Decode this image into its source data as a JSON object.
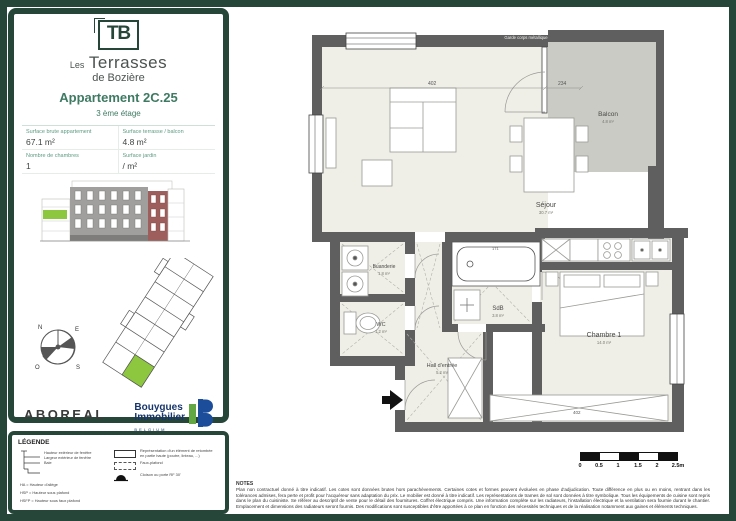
{
  "panel": {
    "logo_monogram": "TB",
    "brand_small": "Les",
    "brand_large": "Terrasses",
    "brand_sub": "de Bozière",
    "apartment_title": "Appartement 2C.25",
    "floor": "3 ème étage",
    "fields": [
      {
        "label": "Surface brute appartement",
        "value": "67.1 m²"
      },
      {
        "label": "Surface terrasse / balcon",
        "value": "4.8 m²"
      },
      {
        "label": "Nombre de chambres",
        "value": "1"
      },
      {
        "label": "Surface jardin",
        "value": "/ m²"
      }
    ],
    "logos": {
      "aboreal": "ABOREAL",
      "bouygues_line1": "Bouygues",
      "bouygues_line2": "Immobilier",
      "bouygues_sub": "BELGIUM"
    }
  },
  "compass": {
    "north": "N",
    "east": "E",
    "south": "S",
    "west": "O"
  },
  "plan": {
    "railing_label": "Garde corps métallique",
    "rooms": {
      "sejour": {
        "name": "Séjour",
        "area": "30.7 m²"
      },
      "balcon": {
        "name": "Balcon",
        "area": "4.8 m²"
      },
      "chambre1": {
        "name": "Chambre 1",
        "area": "14.0 m²"
      },
      "sdb": {
        "name": "SdB",
        "area": "3.8 m²"
      },
      "hall": {
        "name": "Hall d'entrée",
        "area": "5.2 m²"
      },
      "buanderie": {
        "name": "Buanderie",
        "area": "1.8 m²"
      },
      "wc": {
        "name": "WC",
        "area": "1.2 m²"
      }
    },
    "dimensions": {
      "sejour_width": "402",
      "bay_width": "234",
      "tub_width": "171",
      "wardrobe_width": "402"
    }
  },
  "legend": {
    "title": "LÉGENDE",
    "window_labels": {
      "l1": "Hauteur extérieur de fenêtre",
      "l2": "Largeur extérieur de fenêtre",
      "l3": "Baie"
    },
    "abbreviations": {
      "a1": "HA = Hauteur d'allège",
      "a2": "HSP = Hauteur sous plafond",
      "a3": "HSFP = Hauteur sous faux plafond"
    },
    "symbols": {
      "beam": "Représentation d'un élément de retombée en partie haute (poutre, linteau, ...)",
      "false_ceiling": "Faux-plafond",
      "fire_door": "Cloison ou porte RF 30'"
    }
  },
  "scalebar": {
    "ticks": [
      "0",
      "0.5",
      "1",
      "1.5",
      "2",
      "2.5m"
    ]
  },
  "notes": {
    "title": "NOTES",
    "body": "Plan non contractuel donné à titre indicatif. Les cotes sont données brutes hors parachèvements. Certaines cotes et formes peuvent évoluées en phase d'adjudication. Toute différence en plus ou en moins, rentrant dans les tolérances admises, fera perte et profit pour l'acquéreur sans adaptation du prix. Le mobilier est donné à titre indicatif. Les représentations de trames de sol sont données à titre symbolique. Tous les équipements de cuisine sont repris dans le plan du cuisiniste. Se référer au descriptif de vente pour le détail des fournitures. Coffret électrique compris. Une information complète sur les radiateurs, l'installation électrique et la ventilation sera fournie durant le chantier. Emplacement et dimensions des radiateurs seront fournis. Des modifications sont susceptibles d'être apportées à ce plan en fonction des nécessités techniques et de la réalisation notamment aux gaines et éléments techniques."
  }
}
